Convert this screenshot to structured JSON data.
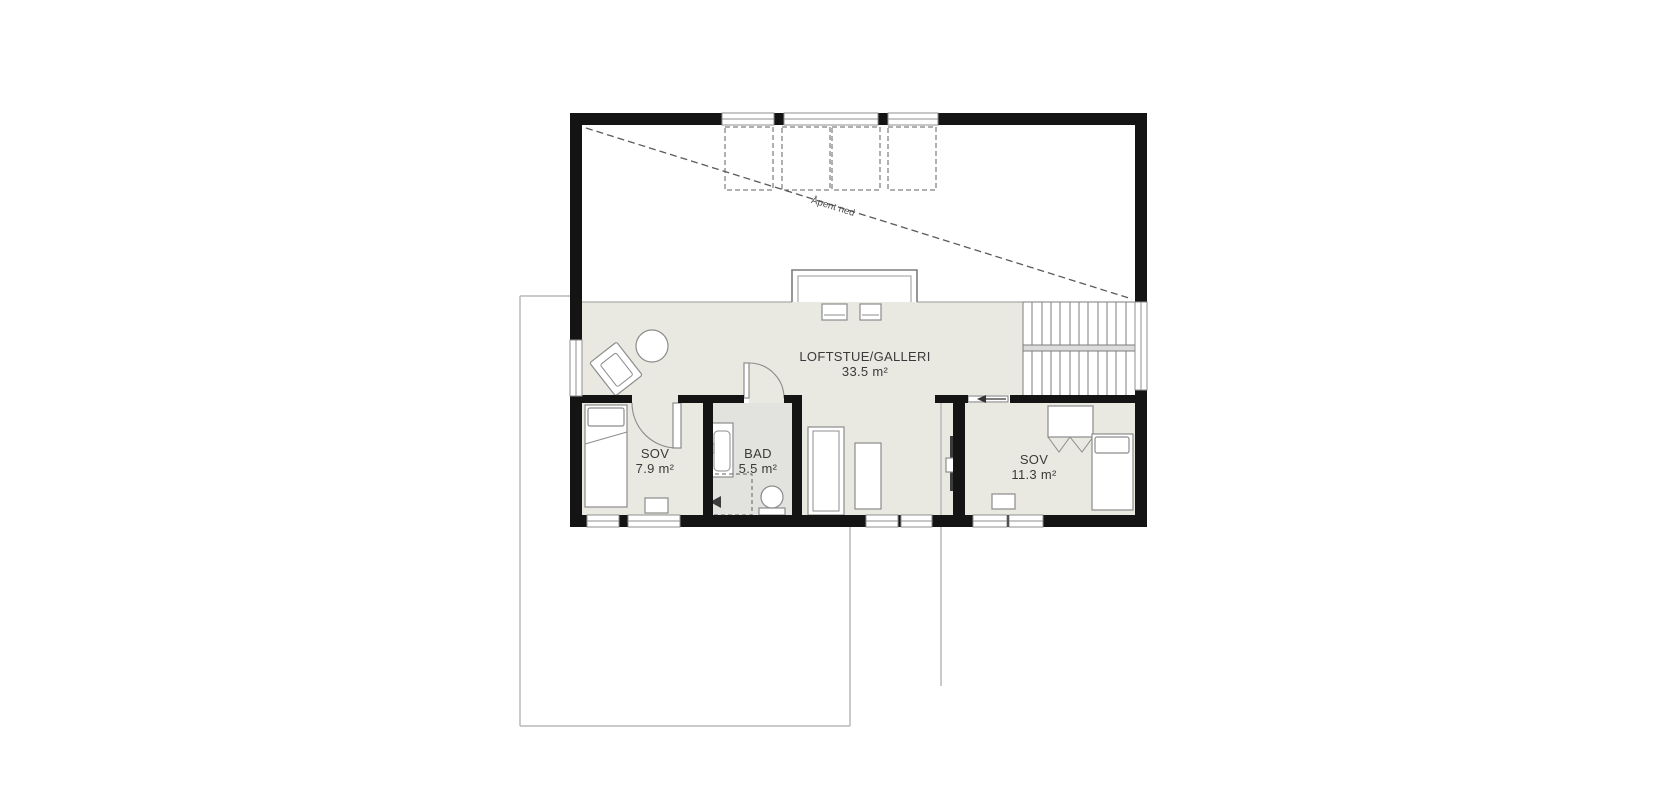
{
  "plan": {
    "annotations": {
      "open_to_below": "Åpent ned"
    },
    "rooms": [
      {
        "name": "LOFTSTUE/GALLERI",
        "area": "33.5 m²"
      },
      {
        "name": "SOV",
        "area": "7.9 m²"
      },
      {
        "name": "BAD",
        "area": "5.5 m²"
      },
      {
        "name": "SOV",
        "area": "11.3 m²"
      }
    ],
    "colors": {
      "background": "#ffffff",
      "wall": "#141414",
      "floor": "#e9e8e1",
      "bath-floor": "#e2e2de",
      "outline": "#b9b9b9",
      "detail": "#8c8c8c",
      "text": "#3a3a3a"
    }
  }
}
